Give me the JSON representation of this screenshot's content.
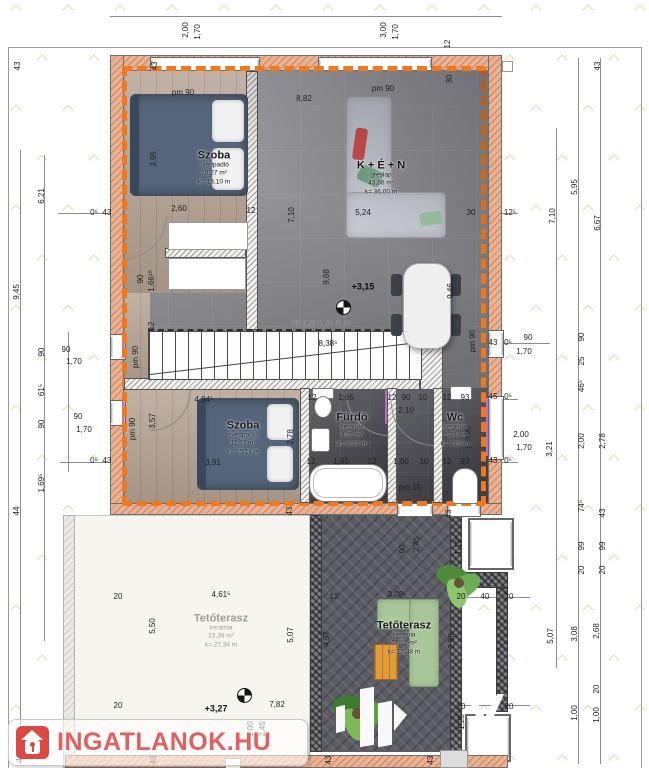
{
  "plan": {
    "rooms": {
      "szoba1": {
        "name": "Szoba",
        "floor_type": "svédpadló",
        "area": "10,27 m²",
        "perimeter": "k= 13,10 m"
      },
      "nappali": {
        "name": "K + É + N",
        "floor_type": "greslap",
        "area": "43,86 m²",
        "perimeter": "k= 36,00 m"
      },
      "szoba2": {
        "name": "Szoba",
        "floor_type": "svédpadló",
        "area": "11,37 m²",
        "perimeter": "k= 15,14 m"
      },
      "furdo": {
        "name": "Fürdő",
        "floor_type": "kerámia",
        "area": "4,01 m²",
        "perimeter": "k= 8,34 m"
      },
      "wc": {
        "name": "Wc",
        "floor_type": "kerámia",
        "area": "2,38 m²",
        "perimeter": "k= 7,00 m"
      },
      "terasz_bal": {
        "name": "Tetőterasz",
        "floor_type": "kerámia",
        "area": "23,36 m²",
        "perimeter": "k= 27,34 m"
      },
      "terasz_jobb": {
        "name": "Tetőterasz",
        "floor_type": "kerámia",
        "area": "17,21 m²",
        "perimeter": "k= 17,48 m"
      }
    },
    "stair_note": "PF 4,25 /1,00 /0,35",
    "colors": {
      "insulation_dash": "#F0791F",
      "wall_fill": "#EAB292",
      "brand_red": "#DC4843"
    },
    "dims": [
      {
        "t": "2,00",
        "x": 186,
        "y": 30,
        "r": 1
      },
      {
        "t": "1,70",
        "x": 198,
        "y": 32,
        "r": 1
      },
      {
        "t": "3,00",
        "x": 384,
        "y": 30,
        "r": 1
      },
      {
        "t": "1,70",
        "x": 396,
        "y": 32,
        "r": 1
      },
      {
        "t": "12",
        "x": 448,
        "y": 44,
        "r": 1
      },
      {
        "t": "43",
        "x": 155,
        "y": 66,
        "r": 1
      },
      {
        "t": "43",
        "x": 598,
        "y": 66,
        "r": 1
      },
      {
        "t": "30",
        "x": 450,
        "y": 79,
        "r": 1
      },
      {
        "t": "43",
        "x": 18,
        "y": 66,
        "r": 1
      },
      {
        "t": "6,21",
        "x": 42,
        "y": 196,
        "r": 1
      },
      {
        "t": "9,45",
        "x": 17,
        "y": 292,
        "r": 1
      },
      {
        "t": "0⁵",
        "x": 94,
        "y": 213
      },
      {
        "t": "43",
        "x": 107,
        "y": 213
      },
      {
        "t": "90",
        "x": 42,
        "y": 352,
        "r": 1
      },
      {
        "t": "61⁵",
        "x": 42,
        "y": 390,
        "r": 1
      },
      {
        "t": "90",
        "x": 42,
        "y": 424,
        "r": 1
      },
      {
        "t": "1,69⁵",
        "x": 42,
        "y": 483,
        "r": 1
      },
      {
        "t": "44",
        "x": 17,
        "y": 511,
        "r": 1
      },
      {
        "t": "90",
        "x": 66,
        "y": 350
      },
      {
        "t": "1,70",
        "x": 74,
        "y": 362
      },
      {
        "t": "90",
        "x": 78,
        "y": 417
      },
      {
        "t": "1,70",
        "x": 84,
        "y": 430
      },
      {
        "t": "0⁵",
        "x": 94,
        "y": 461
      },
      {
        "t": "43",
        "x": 107,
        "y": 461
      },
      {
        "t": "12⁵",
        "x": 510,
        "y": 213
      },
      {
        "t": "7,10",
        "x": 553,
        "y": 216,
        "r": 1
      },
      {
        "t": "5,95",
        "x": 575,
        "y": 187,
        "r": 1
      },
      {
        "t": "6,67",
        "x": 598,
        "y": 223,
        "r": 1
      },
      {
        "t": "43",
        "x": 493,
        "y": 343
      },
      {
        "t": "0⁵",
        "x": 508,
        "y": 343
      },
      {
        "t": "90",
        "x": 528,
        "y": 338
      },
      {
        "t": "1,70",
        "x": 524,
        "y": 352
      },
      {
        "t": "pm 90",
        "x": 473,
        "y": 341,
        "r": 1
      },
      {
        "t": "90",
        "x": 582,
        "y": 337,
        "r": 1
      },
      {
        "t": "25",
        "x": 582,
        "y": 361,
        "r": 1
      },
      {
        "t": "46⁵",
        "x": 582,
        "y": 386,
        "r": 1
      },
      {
        "t": "2,00",
        "x": 582,
        "y": 441,
        "r": 1
      },
      {
        "t": "74⁵",
        "x": 582,
        "y": 506,
        "r": 1
      },
      {
        "t": "99",
        "x": 582,
        "y": 546,
        "r": 1
      },
      {
        "t": "20",
        "x": 582,
        "y": 570,
        "r": 1
      },
      {
        "t": "2,78",
        "x": 603,
        "y": 441,
        "r": 1
      },
      {
        "t": "43",
        "x": 603,
        "y": 513,
        "r": 1
      },
      {
        "t": "99",
        "x": 603,
        "y": 546,
        "r": 1
      },
      {
        "t": "20",
        "x": 603,
        "y": 570,
        "r": 1
      },
      {
        "t": "3,21",
        "x": 550,
        "y": 449,
        "r": 1
      },
      {
        "t": "45",
        "x": 493,
        "y": 397
      },
      {
        "t": "0⁵",
        "x": 508,
        "y": 397
      },
      {
        "t": "2,00",
        "x": 521,
        "y": 435
      },
      {
        "t": "1,70",
        "x": 524,
        "y": 448
      },
      {
        "t": "43",
        "x": 493,
        "y": 461
      },
      {
        "t": "0⁵",
        "x": 508,
        "y": 461
      },
      {
        "t": "5,07",
        "x": 551,
        "y": 636,
        "r": 1
      },
      {
        "t": "3,08",
        "x": 575,
        "y": 634,
        "r": 1
      },
      {
        "t": "2,68",
        "x": 597,
        "y": 631,
        "r": 1
      },
      {
        "t": "20",
        "x": 597,
        "y": 689,
        "r": 1
      },
      {
        "t": "1,00",
        "x": 575,
        "y": 713,
        "r": 1
      },
      {
        "t": "1,00",
        "x": 597,
        "y": 715,
        "r": 1
      },
      {
        "t": "20",
        "x": 118,
        "y": 597
      },
      {
        "t": "4,61⁵",
        "x": 221,
        "y": 595
      },
      {
        "t": "5,50",
        "x": 153,
        "y": 626,
        "r": 1
      },
      {
        "t": "5,07",
        "x": 291,
        "y": 635,
        "r": 1
      },
      {
        "t": "20",
        "x": 118,
        "y": 706
      },
      {
        "t": "+3,27",
        "x": 216,
        "y": 709,
        "c": "lvl-t"
      },
      {
        "t": "7,82",
        "x": 277,
        "y": 705
      },
      {
        "t": "1,00",
        "x": 251,
        "y": 729,
        "r": 1
      },
      {
        "t": "2,45",
        "x": 263,
        "y": 729,
        "r": 1
      },
      {
        "t": "90",
        "x": 403,
        "y": 549,
        "r": 1
      },
      {
        "t": "2,45",
        "x": 417,
        "y": 544,
        "r": 1
      },
      {
        "t": "1,19",
        "x": 459,
        "y": 547,
        "r": 1
      },
      {
        "t": "12",
        "x": 334,
        "y": 597
      },
      {
        "t": "3,08⁵",
        "x": 397,
        "y": 595
      },
      {
        "t": "20",
        "x": 461,
        "y": 597
      },
      {
        "t": "40",
        "x": 485,
        "y": 597
      },
      {
        "t": "20",
        "x": 509,
        "y": 597
      },
      {
        "t": "4,97",
        "x": 327,
        "y": 639,
        "r": 1
      },
      {
        "t": "2,68",
        "x": 452,
        "y": 641,
        "r": 1
      },
      {
        "t": "20",
        "x": 461,
        "y": 707
      },
      {
        "t": "1,20",
        "x": 462,
        "y": 722,
        "r": 1
      },
      {
        "t": "20",
        "x": 509,
        "y": 707
      },
      {
        "t": "43",
        "x": 329,
        "y": 760,
        "r": 1
      },
      {
        "t": "43",
        "x": 431,
        "y": 760,
        "r": 1
      },
      {
        "t": "43",
        "x": 20,
        "y": 758,
        "r": 1
      },
      {
        "t": "43",
        "x": 154,
        "y": 760,
        "r": 1
      },
      {
        "t": "pm 90",
        "x": 183,
        "y": 93
      },
      {
        "t": "8,82",
        "x": 304,
        "y": 99
      },
      {
        "t": "pm 90",
        "x": 383,
        "y": 89
      },
      {
        "t": "3,95",
        "x": 154,
        "y": 159,
        "r": 1
      },
      {
        "t": "2,60",
        "x": 179,
        "y": 209
      },
      {
        "t": "12",
        "x": 251,
        "y": 211
      },
      {
        "t": "7,10",
        "x": 292,
        "y": 215,
        "r": 1
      },
      {
        "t": "5,24",
        "x": 363,
        "y": 213
      },
      {
        "t": "30",
        "x": 471,
        "y": 213
      },
      {
        "t": "90",
        "x": 141,
        "y": 279,
        "r": 1
      },
      {
        "t": "1,66¹⁰",
        "x": 152,
        "y": 281,
        "r": 1
      },
      {
        "t": "12",
        "x": 152,
        "y": 326,
        "r": 1
      },
      {
        "t": "9,88",
        "x": 327,
        "y": 277,
        "r": 1
      },
      {
        "t": "+3,15",
        "x": 363,
        "y": 287,
        "c": "lvl-t"
      },
      {
        "t": "9,46",
        "x": 451,
        "y": 291,
        "r": 1
      },
      {
        "t": "8,38⁵",
        "x": 328,
        "y": 344
      },
      {
        "t": "pm 90",
        "x": 136,
        "y": 357,
        "r": 1
      },
      {
        "t": "3,57",
        "x": 153,
        "y": 421,
        "r": 1
      },
      {
        "t": "4,94⁵",
        "x": 204,
        "y": 400
      },
      {
        "t": "3,91",
        "x": 213,
        "y": 463
      },
      {
        "t": "2,78",
        "x": 291,
        "y": 437,
        "r": 1
      },
      {
        "t": "pm 90",
        "x": 133,
        "y": 429,
        "r": 1
      },
      {
        "t": "12",
        "x": 312,
        "y": 398
      },
      {
        "t": "1,65",
        "x": 346,
        "y": 398
      },
      {
        "t": "12",
        "x": 392,
        "y": 398
      },
      {
        "t": "90",
        "x": 406,
        "y": 398
      },
      {
        "t": "10",
        "x": 423,
        "y": 398
      },
      {
        "t": "12",
        "x": 447,
        "y": 398
      },
      {
        "t": "93",
        "x": 465,
        "y": 398
      },
      {
        "t": "2,10",
        "x": 406,
        "y": 411
      },
      {
        "t": "12",
        "x": 311,
        "y": 462
      },
      {
        "t": "1,65",
        "x": 341,
        "y": 462
      },
      {
        "t": "12",
        "x": 372,
        "y": 462
      },
      {
        "t": "1,00",
        "x": 401,
        "y": 462
      },
      {
        "t": "10",
        "x": 424,
        "y": 462
      },
      {
        "t": "12",
        "x": 447,
        "y": 462
      },
      {
        "t": "93",
        "x": 465,
        "y": 462
      },
      {
        "t": "pm 90",
        "x": 468,
        "y": 437,
        "r": 1
      },
      {
        "t": "pm 15",
        "x": 410,
        "y": 488
      },
      {
        "t": "43",
        "x": 290,
        "y": 511,
        "r": 1
      },
      {
        "t": "43",
        "x": 449,
        "y": 514,
        "r": 1
      }
    ]
  },
  "watermark": {
    "brand": "INGATLANOK.HU",
    "logo_letter": "N"
  }
}
